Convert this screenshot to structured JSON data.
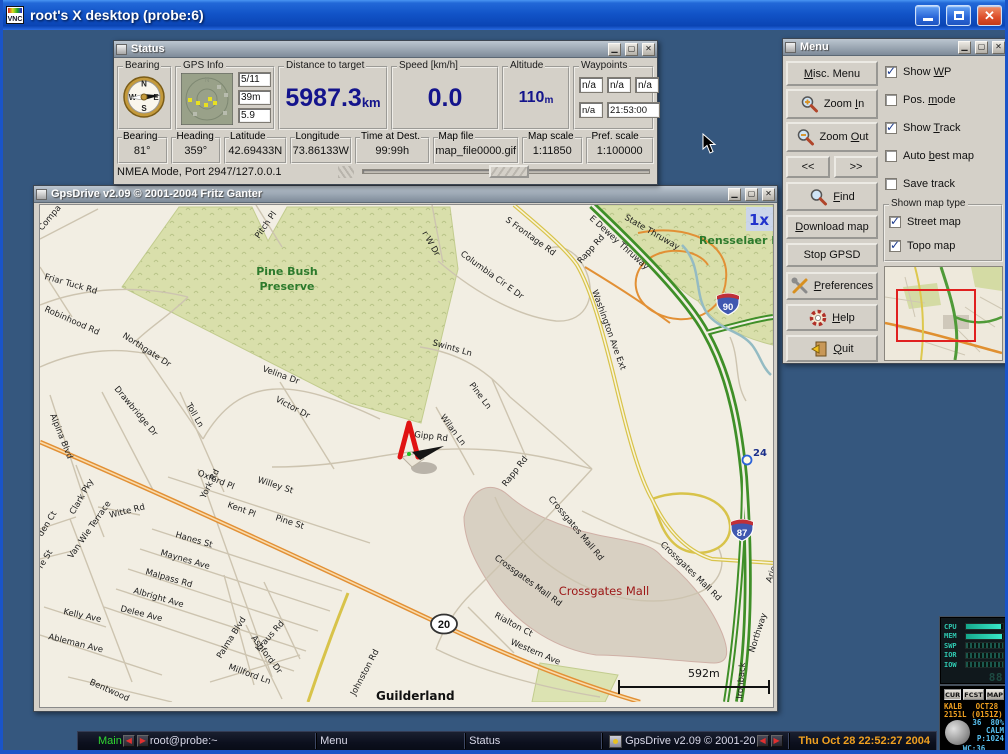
{
  "colors": {
    "desktop": "#35577e",
    "titlebar_blue": "#2268d8",
    "value_blue": "#14148c",
    "clock_orange": "#f0a020"
  },
  "window": {
    "title": "root's X desktop (probe:6)"
  },
  "status_window": {
    "title": "Status",
    "compass": [
      "N",
      "W",
      "S",
      "E"
    ],
    "bearing_frame": {
      "label": "Bearing"
    },
    "gps_info": {
      "label": "GPS Info",
      "north_label": "N",
      "sats": "5/11",
      "alt": "39m",
      "dop": "5.9"
    },
    "distance": {
      "label": "Distance to target",
      "value": "5987.3",
      "unit": "km"
    },
    "speed": {
      "label": "Speed [km/h]",
      "value": "0.0"
    },
    "altitude": {
      "label": "Altitude",
      "value": "110",
      "unit": "m"
    },
    "waypoints": {
      "label": "Waypoints",
      "row1": [
        "n/a",
        "n/a",
        "n/a"
      ],
      "row2": [
        "n/a",
        "21:53:00"
      ]
    },
    "fields": [
      {
        "label": "Bearing",
        "value": "81°"
      },
      {
        "label": "Heading",
        "value": "359°"
      },
      {
        "label": "Latitude",
        "value": "42.69433N"
      },
      {
        "label": "Longitude",
        "value": "73.86133W"
      },
      {
        "label": "Time at Dest.",
        "value": "99:99h"
      },
      {
        "label": "Map file",
        "value": "map_file0000.gif"
      },
      {
        "label": "Map scale",
        "value": "1:11850"
      },
      {
        "label": "Pref. scale",
        "value": "1:100000"
      }
    ],
    "statusbar": "NMEA Mode, Port 2947/127.0.0.1"
  },
  "menu_window": {
    "title": "Menu",
    "buttons": [
      {
        "id": "misc-menu",
        "label": "Misc. Menu",
        "underline": "M"
      },
      {
        "id": "zoom-in",
        "label": "Zoom In",
        "underline": "I"
      },
      {
        "id": "zoom-out",
        "label": "Zoom Out",
        "underline": "O"
      },
      {
        "id": "map-prev",
        "label": "<<",
        "underline": ""
      },
      {
        "id": "map-next",
        "label": ">>",
        "underline": ""
      },
      {
        "id": "find",
        "label": "Find",
        "underline": "F"
      },
      {
        "id": "download-map",
        "label": "Download map",
        "underline": "D"
      },
      {
        "id": "stop-gpsd",
        "label": "Stop GPSD",
        "underline": ""
      },
      {
        "id": "preferences",
        "label": "Preferences",
        "underline": "P"
      },
      {
        "id": "help",
        "label": "Help",
        "underline": "H"
      },
      {
        "id": "quit",
        "label": "Quit",
        "underline": "Q"
      }
    ],
    "checkboxes": [
      {
        "id": "show-wp",
        "label": "Show WP",
        "checked": true,
        "underline": "W"
      },
      {
        "id": "pos-mode",
        "label": "Pos. mode",
        "checked": false,
        "underline": "m"
      },
      {
        "id": "show-track",
        "label": "Show Track",
        "checked": true,
        "underline": "T"
      },
      {
        "id": "auto-best-map",
        "label": "Auto best map",
        "checked": false,
        "underline": "b"
      },
      {
        "id": "save-track",
        "label": "Save track",
        "checked": false,
        "underline": ""
      }
    ],
    "map_type": {
      "label": "Shown map type",
      "options": [
        {
          "id": "street-map",
          "label": "Street map",
          "checked": true
        },
        {
          "id": "topo-map",
          "label": "Topo map",
          "checked": true
        }
      ]
    }
  },
  "map_window": {
    "title": "GpsDrive v2.09  © 2001-2004 Fritz Ganter",
    "zoom_level": "1x",
    "scale_label": "592m",
    "waypoint_label": "24",
    "shields": {
      "interstate_90": "90",
      "interstate_87": "87",
      "us_20": "20"
    },
    "labels": [
      {
        "text": "Compa",
        "x": 2,
        "y": 26,
        "r": -50
      },
      {
        "text": "Friar Tuck Rd",
        "x": 4,
        "y": 74,
        "r": 16
      },
      {
        "text": "Robinhood Rd",
        "x": 4,
        "y": 106,
        "r": 24
      },
      {
        "text": "Northgate Dr",
        "x": 82,
        "y": 132,
        "r": 33
      },
      {
        "text": "Drawbridge Dr",
        "x": 74,
        "y": 184,
        "r": 50
      },
      {
        "text": "Toll Ln",
        "x": 146,
        "y": 200,
        "r": 60
      },
      {
        "text": "Velina Dr",
        "x": 222,
        "y": 166,
        "r": 20
      },
      {
        "text": "Victor Dr",
        "x": 235,
        "y": 196,
        "r": 28
      },
      {
        "text": "Pitch Pl",
        "x": 219,
        "y": 34,
        "r": -55
      },
      {
        "text": "Alpina Blvd",
        "x": 10,
        "y": 210,
        "r": 68
      },
      {
        "text": "r W Dr",
        "x": 382,
        "y": 28,
        "r": 60
      },
      {
        "text": "Columbia Cir E Dr",
        "x": 420,
        "y": 50,
        "r": 36
      },
      {
        "text": "S Frontage Rd",
        "x": 465,
        "y": 16,
        "r": 36
      },
      {
        "text": "Rapp Rd",
        "x": 541,
        "y": 59,
        "r": -48
      },
      {
        "text": "State Thruway",
        "x": 584,
        "y": 14,
        "r": 30
      },
      {
        "text": "E Dewey Thruway",
        "x": 549,
        "y": 14,
        "r": 42
      },
      {
        "text": "Washington Ave Ext",
        "x": 552,
        "y": 86,
        "r": 70
      },
      {
        "text": "Swints Ln",
        "x": 392,
        "y": 140,
        "r": 16
      },
      {
        "text": "Pine Ln",
        "x": 429,
        "y": 180,
        "r": 53
      },
      {
        "text": "Wilan Ln",
        "x": 400,
        "y": 212,
        "r": 53
      },
      {
        "text": "Gipp Rd",
        "x": 374,
        "y": 232,
        "r": 7
      },
      {
        "text": "Rapp Rd",
        "x": 466,
        "y": 282,
        "r": -52
      },
      {
        "text": "Crossgates Mall Rd",
        "x": 508,
        "y": 294,
        "r": 50
      },
      {
        "text": "Crossgates Mall Rd",
        "x": 454,
        "y": 354,
        "r": 36
      },
      {
        "text": "Crossgates Mall Rd",
        "x": 620,
        "y": 340,
        "r": 44
      },
      {
        "text": "Rialton Ct",
        "x": 454,
        "y": 412,
        "r": 28
      },
      {
        "text": "Western Ave",
        "x": 470,
        "y": 439,
        "r": 23
      },
      {
        "text": "Johnston Rd",
        "x": 315,
        "y": 491,
        "r": -62
      },
      {
        "text": "Oxford Pl",
        "x": 157,
        "y": 270,
        "r": 22
      },
      {
        "text": "Willey St",
        "x": 217,
        "y": 277,
        "r": 18
      },
      {
        "text": "York Rd",
        "x": 165,
        "y": 294,
        "r": -63
      },
      {
        "text": "Kent Pl",
        "x": 187,
        "y": 302,
        "r": 20
      },
      {
        "text": "Pine St",
        "x": 235,
        "y": 315,
        "r": 18
      },
      {
        "text": "Hanes St",
        "x": 135,
        "y": 332,
        "r": 16
      },
      {
        "text": "Maynes Ave",
        "x": 120,
        "y": 350,
        "r": 16
      },
      {
        "text": "Malpass Rd",
        "x": 105,
        "y": 369,
        "r": 16
      },
      {
        "text": "Albright Ave",
        "x": 93,
        "y": 388,
        "r": 16
      },
      {
        "text": "Delee Ave",
        "x": 80,
        "y": 406,
        "r": 14
      },
      {
        "text": "Kelly Ave",
        "x": 23,
        "y": 409,
        "r": 12
      },
      {
        "text": "Ableman Ave",
        "x": 8,
        "y": 434,
        "r": 14
      },
      {
        "text": "Bentwood",
        "x": 49,
        "y": 479,
        "r": 24
      },
      {
        "text": "Clark Pky",
        "x": 34,
        "y": 310,
        "r": -60
      },
      {
        "text": "Van Wie Terrace",
        "x": 32,
        "y": 354,
        "r": -55
      },
      {
        "text": "den Ct",
        "x": 2,
        "y": 332,
        "r": -58
      },
      {
        "text": "re St",
        "x": 2,
        "y": 364,
        "r": -58
      },
      {
        "text": "Witte Rd",
        "x": 70,
        "y": 313,
        "r": -14
      },
      {
        "text": "Palma Blvd",
        "x": 181,
        "y": 454,
        "r": -58
      },
      {
        "text": "Kraus Rd",
        "x": 219,
        "y": 447,
        "r": -48
      },
      {
        "text": "Ashford Dr",
        "x": 211,
        "y": 433,
        "r": 53
      },
      {
        "text": "Millford Ln",
        "x": 188,
        "y": 464,
        "r": 20
      },
      {
        "text": "Northway",
        "x": 714,
        "y": 448,
        "r": -72
      },
      {
        "text": "Ironback",
        "x": 702,
        "y": 494,
        "r": -85
      },
      {
        "text": "Arie",
        "x": 731,
        "y": 378,
        "r": -70
      },
      {
        "text": "Pine Bush",
        "x": 247,
        "y": 70,
        "r": 0,
        "cls": "green",
        "anchor": "middle"
      },
      {
        "text": "Preserve",
        "x": 247,
        "y": 85,
        "r": 0,
        "cls": "green",
        "anchor": "middle"
      },
      {
        "text": "Rensselaer Lan",
        "x": 659,
        "y": 39,
        "r": 0,
        "cls": "green"
      },
      {
        "text": "Crossgates Mall",
        "x": 564,
        "y": 390,
        "r": 0,
        "cls": "red",
        "anchor": "middle"
      },
      {
        "text": "Guilderland",
        "x": 336,
        "y": 495,
        "r": 0,
        "cls": "city"
      }
    ]
  },
  "taskbar": {
    "main_label": "Main",
    "terminal_label": "root@probe:~",
    "menu_label": "Menu",
    "status_label": "Status",
    "gpsdrive_label": "GpsDrive v2.09  © 2001-20",
    "clock": "Thu Oct 28 22:52:27 2004"
  },
  "sysmon": {
    "rows": [
      {
        "label": "CPU",
        "fill": 0.94,
        "striped": false
      },
      {
        "label": "MEM",
        "fill": 0.97,
        "striped": false
      },
      {
        "label": "SWP",
        "fill": 1,
        "striped": true
      },
      {
        "label": "IOR",
        "fill": 1,
        "striped": true
      },
      {
        "label": "IOW",
        "fill": 1,
        "striped": true
      }
    ],
    "lcd_dim": "88 88.",
    "lcd_bright": "28.32"
  },
  "weather": {
    "buttons": [
      "CUR",
      "FCST",
      "MAP"
    ],
    "station_line": "KALB   OCT28",
    "time_line": "2151L (0151Z)",
    "temp_humidity": "36  80%",
    "wind": "CALM",
    "pressure": "P:1024",
    "wind_chill": "WC:36"
  }
}
